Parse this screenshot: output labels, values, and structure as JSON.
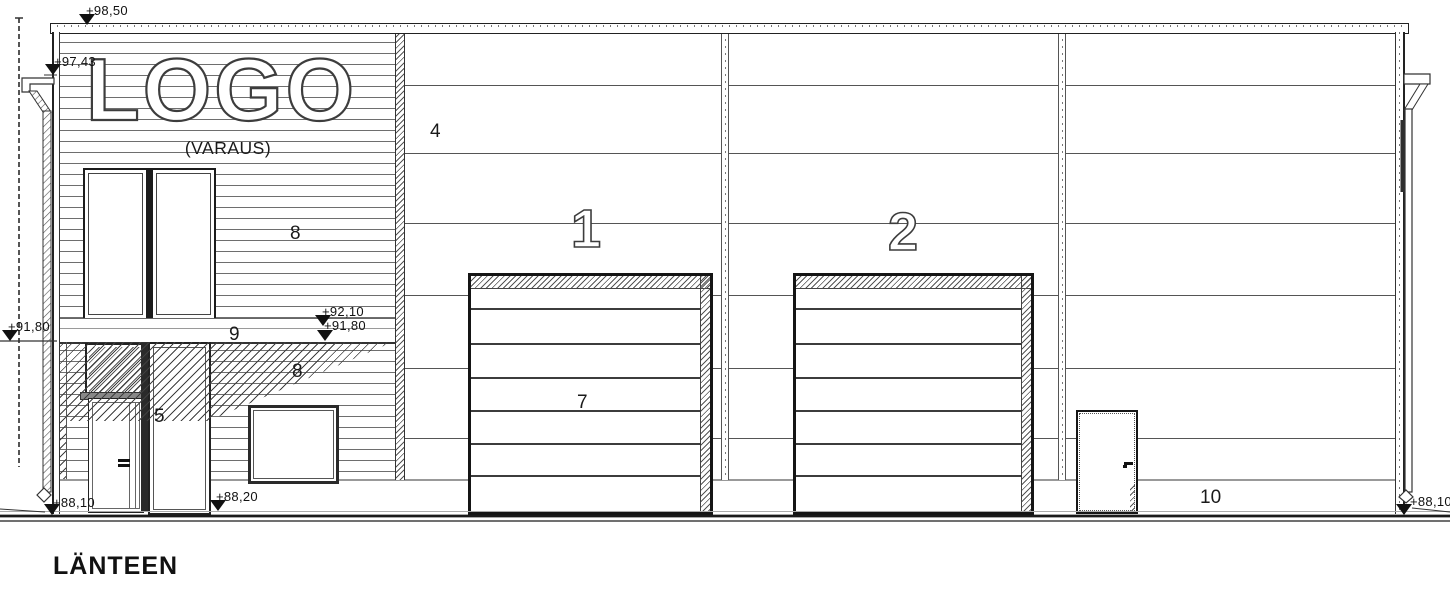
{
  "drawing": {
    "title": "LÄNTEEN",
    "sign_text": "LOGO",
    "sign_subtext": "(VARAUS)"
  },
  "keynotes": {
    "door1": "1",
    "door2": "2",
    "wall_panel": "4",
    "panel_door": "5",
    "sectional_door": "7",
    "siding_upper": "8",
    "siding_lower": "8",
    "canopy_band": "9",
    "plinth": "10"
  },
  "elevation_marks": {
    "parapet": "+98,50",
    "eave": "+97,43",
    "canopy_top": "+92,10",
    "canopy_bottom": "+91,80",
    "canopy_left": "+91,80",
    "ground_left": "+88,10",
    "ground_entrance": "+88,20",
    "ground_right": "+88,10"
  },
  "colors": {
    "line": "#1a1a1a",
    "grey_line": "#999999",
    "hatch": "#444444"
  }
}
